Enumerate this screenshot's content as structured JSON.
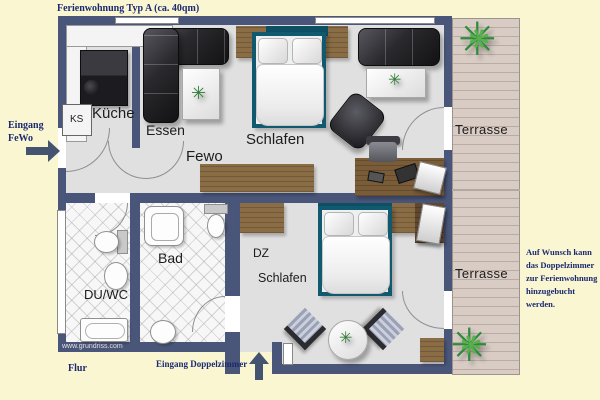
{
  "title": "Ferienwohnung Typ A (ca. 40qm)",
  "labels": {
    "entrance_fewo_line1": "Eingang",
    "entrance_fewo_line2": "FeWo",
    "entrance_dz": "Eingang Doppelzimmer",
    "hallway": "Flur",
    "watermark": "www.grundriss.com"
  },
  "rooms": {
    "kitchen": "Küche",
    "fridge_abbr": "KS",
    "dining": "Essen",
    "apartment_hall": "Fewo",
    "bedroom": "Schlafen",
    "double_room_line1": "DZ",
    "double_room_line2": "Schlafen",
    "shower_wc": "DU/WC",
    "bathroom": "Bad",
    "terrace_top": "Terrasse",
    "terrace_bottom": "Terrasse"
  },
  "note": {
    "lines": [
      "Auf Wunsch kann",
      "das Doppelzimmer",
      "zur Ferienwohnung",
      "hinzugebucht",
      "werden."
    ]
  },
  "icons": {
    "plant": "✳",
    "plant_inner": "❋"
  },
  "colors": {
    "background": "#faf6d2",
    "wall": "#4a5679",
    "floor": "#e0e0e0",
    "wood": "#8a6d45",
    "bed_frame": "#11596e",
    "text_navy": "#1b2a70",
    "terrace": "#d8ccc5"
  }
}
